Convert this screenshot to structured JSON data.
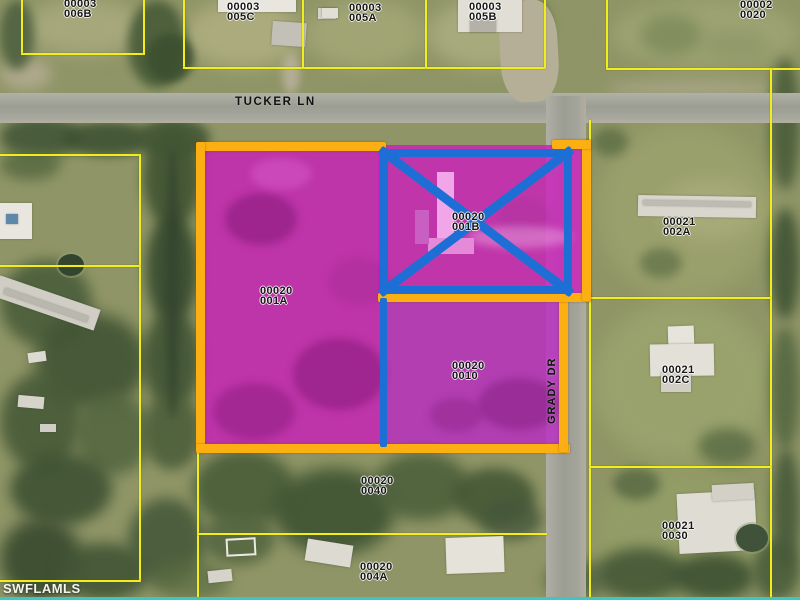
{
  "title": "Aerial parcel map",
  "streets": {
    "horizontal": "TUCKER LN",
    "vertical": "GRADY DR"
  },
  "watermark": "SWFLAMLS",
  "colors": {
    "parcel_line_yellow": "#f2ee1e",
    "highlight_border_orange": "#fbaf12",
    "crossout_blue": "#1d6fd6",
    "highlight_fill_magenta": "#c81eba",
    "watermark_bar_cyan": "#3cc7c4"
  },
  "parcels": [
    {
      "l1": "00003",
      "l2": "006B",
      "highlight": "none"
    },
    {
      "l1": "00003",
      "l2": "005C",
      "highlight": "none"
    },
    {
      "l1": "00003",
      "l2": "005A",
      "highlight": "none"
    },
    {
      "l1": "00003",
      "l2": "005B",
      "highlight": "none"
    },
    {
      "l1": "00002",
      "l2": "0020",
      "highlight": "none"
    },
    {
      "l1": "00021",
      "l2": "002A",
      "highlight": "none"
    },
    {
      "l1": "00021",
      "l2": "002C",
      "highlight": "none"
    },
    {
      "l1": "00021",
      "l2": "0030",
      "highlight": "none"
    },
    {
      "l1": "00020",
      "l2": "001A",
      "highlight": "magenta-outlined"
    },
    {
      "l1": "00020",
      "l2": "001B",
      "highlight": "magenta-crossed-out"
    },
    {
      "l1": "00020",
      "l2": "0010",
      "highlight": "magenta-outlined"
    },
    {
      "l1": "00020",
      "l2": "0040",
      "highlight": "none"
    },
    {
      "l1": "00020",
      "l2": "004A",
      "highlight": "none"
    }
  ]
}
